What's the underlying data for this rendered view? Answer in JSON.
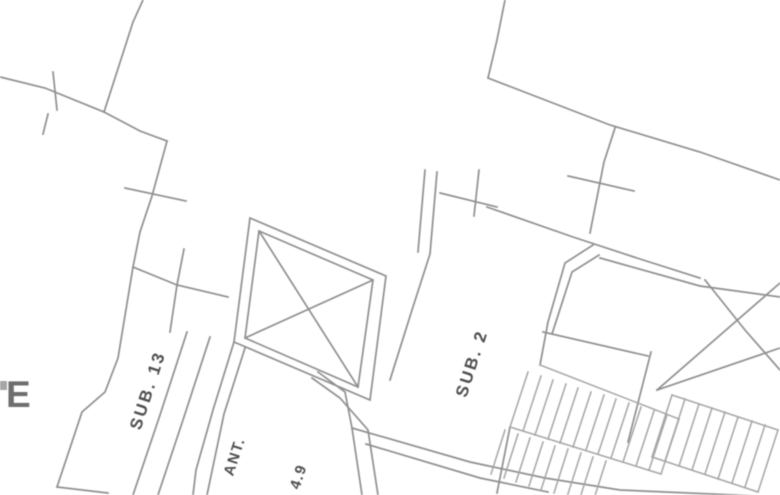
{
  "drawing": {
    "kind": "architectural-floor-plan-crop",
    "labels": {
      "room_left": "SUB. 13",
      "room_right": "SUB. 2",
      "vestibule": "ANT.",
      "vestibule_value": "4.9",
      "edge_text": "E"
    },
    "colors": {
      "background": "#ffffff",
      "wall_line": "#8f8f8f",
      "wall_line_light": "#a6a6a6",
      "label_text": "#4f4f4f",
      "edge_text": "#6e6e6e"
    },
    "plan_rotation_deg": 18,
    "label_rotation_deg": -72
  }
}
